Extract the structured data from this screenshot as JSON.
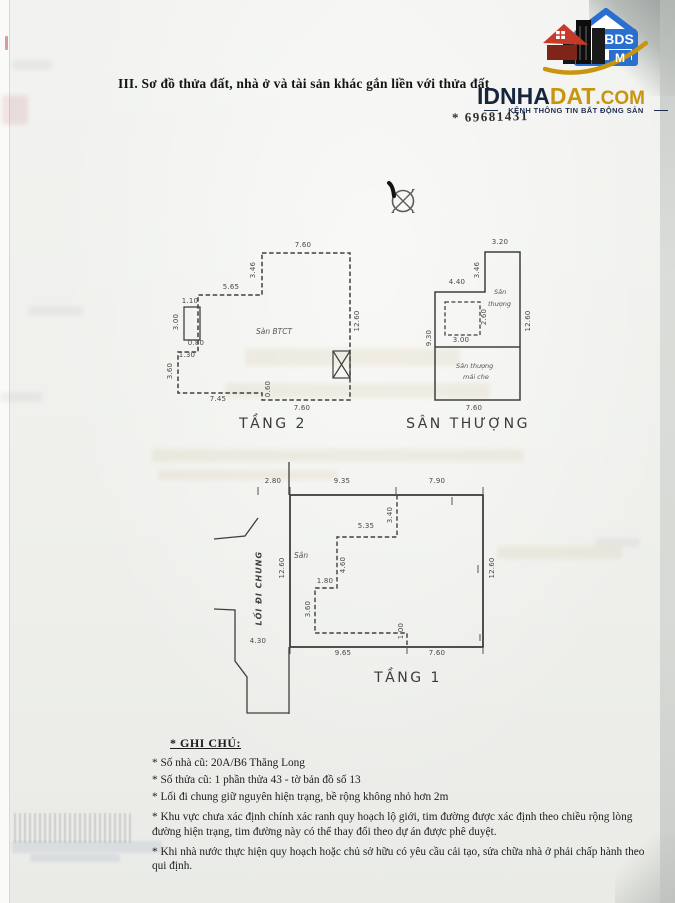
{
  "page": {
    "section_title": "III. Sơ đồ thửa đất, nhà ở và tài sản khác gắn liền với thửa đất",
    "reference_number": "* 69681431"
  },
  "logo": {
    "name_dark": "IDNHA",
    "name_gold": "DAT",
    "name_tld": ".COM",
    "tagline": "KÊNH THÔNG TIN BẤT ĐỘNG SẢN",
    "badge_text": "BDS",
    "badge_sub": "M",
    "colors": {
      "blue": "#2a6fd0",
      "red": "#c63a2a",
      "gold": "#c8960c",
      "dark": "#16243e"
    }
  },
  "plans": {
    "tang2": {
      "title": "TẦNG 2",
      "room_label": "Sàn BTCT",
      "dims": {
        "top": "7.60",
        "top_left_v": "3.46",
        "upper_h": "5.65",
        "niche_top": "1.10",
        "niche_left": "3.00",
        "niche_bottom": "0.80",
        "step": "1.30",
        "left_v": "3.60",
        "bottom_left": "7.45",
        "bottom_step": "0.60",
        "bottom_right": "7.60",
        "right_v": "12.60"
      }
    },
    "san_thuong": {
      "title": "SÂN THƯỢNG",
      "upper_label_1": "Sân",
      "upper_label_2": "thượng",
      "lower_label_1": "Sân thượng",
      "lower_label_2": "mái che",
      "dims": {
        "top": "3.20",
        "step_v": "3.46",
        "upper_h": "4.40",
        "inner_w": "3.00",
        "inner_h": "2.60",
        "left_v": "9.30",
        "right_v": "12.60",
        "bottom": "7.60"
      }
    },
    "tang1": {
      "title": "TẦNG 1",
      "room_label": "Sân",
      "path_label": "LỐI ĐI CHUNG",
      "dims": {
        "offset": "2.80",
        "top_a": "9.35",
        "top_b": "7.90",
        "inner_top_v": "3.40",
        "inner_h": "5.35",
        "inner_mid_v": "4.60",
        "inner_step": "1.80",
        "inner_left_v": "3.60",
        "inner_bot_v": "1.00",
        "left_v": "12.60",
        "right_v": "12.60",
        "bottom_a": "9.65",
        "bottom_b": "7.60",
        "path_w": "4.30"
      }
    }
  },
  "notes": {
    "heading": "* GHI CHÚ:",
    "items": [
      "* Số nhà cũ: 20A/B6 Thăng Long",
      "* Số thửa cũ: 1 phần thửa 43 - tờ bản đồ số 13",
      "* Lối đi chung giữ nguyên hiện trạng, bề rộng không nhỏ hơn 2m",
      "* Khu vực chưa xác định chính xác ranh quy hoạch lộ giới, tim đường được xác định theo chiều rộng lòng đường hiện trạng, tim đường này có thể thay đổi theo dự án được phê duyệt.",
      "* Khi nhà nước thực hiện quy hoạch hoặc chủ sở hữu có yêu cầu cải tạo, sửa chữa nhà ở phải chấp hành theo qui định."
    ]
  }
}
